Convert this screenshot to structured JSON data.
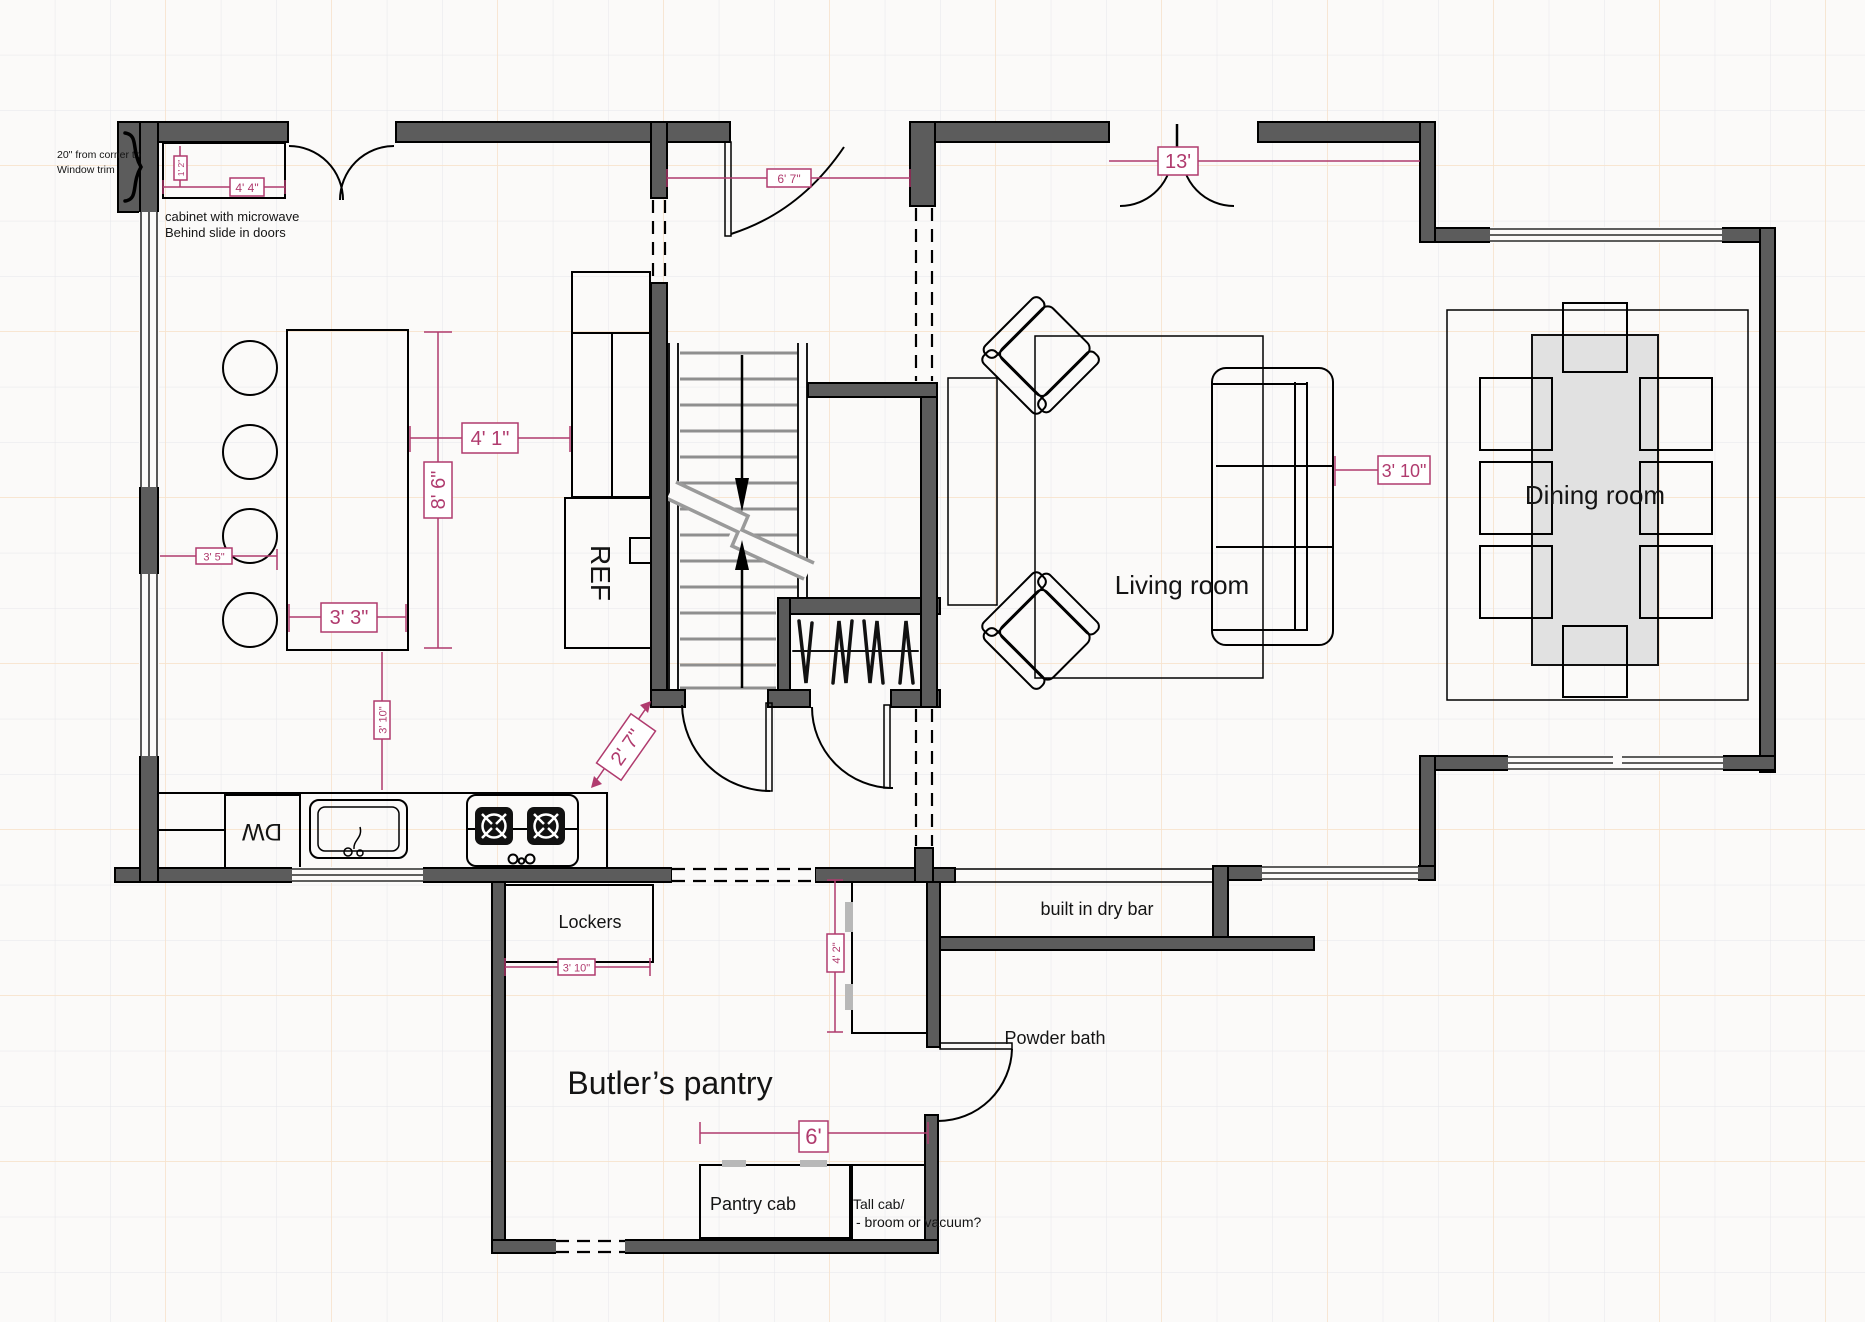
{
  "plan": {
    "rooms": {
      "living": "Living room",
      "dining": "Dining room",
      "butlers_pantry": "Butler’s pantry",
      "powder_bath": "Powder bath"
    },
    "fixtures": {
      "ref": "REF",
      "dw": "DW",
      "lockers": "Lockers",
      "pantry_cab": "Pantry cab",
      "tall_cab_line1": "Tall cab/",
      "tall_cab_line2": "- broom or vacuum?",
      "dry_bar": "built in dry bar"
    },
    "notes": {
      "corner_line1": "20\" from corner to",
      "corner_line2": "Window trim",
      "microwave_line1": "cabinet with microwave",
      "microwave_line2": "Behind slide in doors"
    },
    "dimensions": {
      "cabinet_width": "4' 4\"",
      "cabinet_depth": "1' 2\"",
      "entry_hall": "6' 7\"",
      "patio_doors": "13'",
      "island_to_cabinets": "4' 1\"",
      "island_length": "8' 6\"",
      "wall_to_stools": "3' 5\"",
      "island_width": "3' 3\"",
      "island_to_range": "3' 10\"",
      "stair_to_counter": "2' 7\"",
      "sofa_to_dining": "3' 10\"",
      "lockers_width": "3' 10\"",
      "powder_cab": "4' 2\"",
      "pantry_run": "6'"
    },
    "colors": {
      "wall": "#5c5c5c",
      "dim": "#b03b6e",
      "grid_minor": "#e6e6ea",
      "grid_major": "#f7e3cd",
      "table": "#e1e1e1",
      "tread": "#8f8f8f",
      "bg": "#fbfaf9"
    }
  }
}
